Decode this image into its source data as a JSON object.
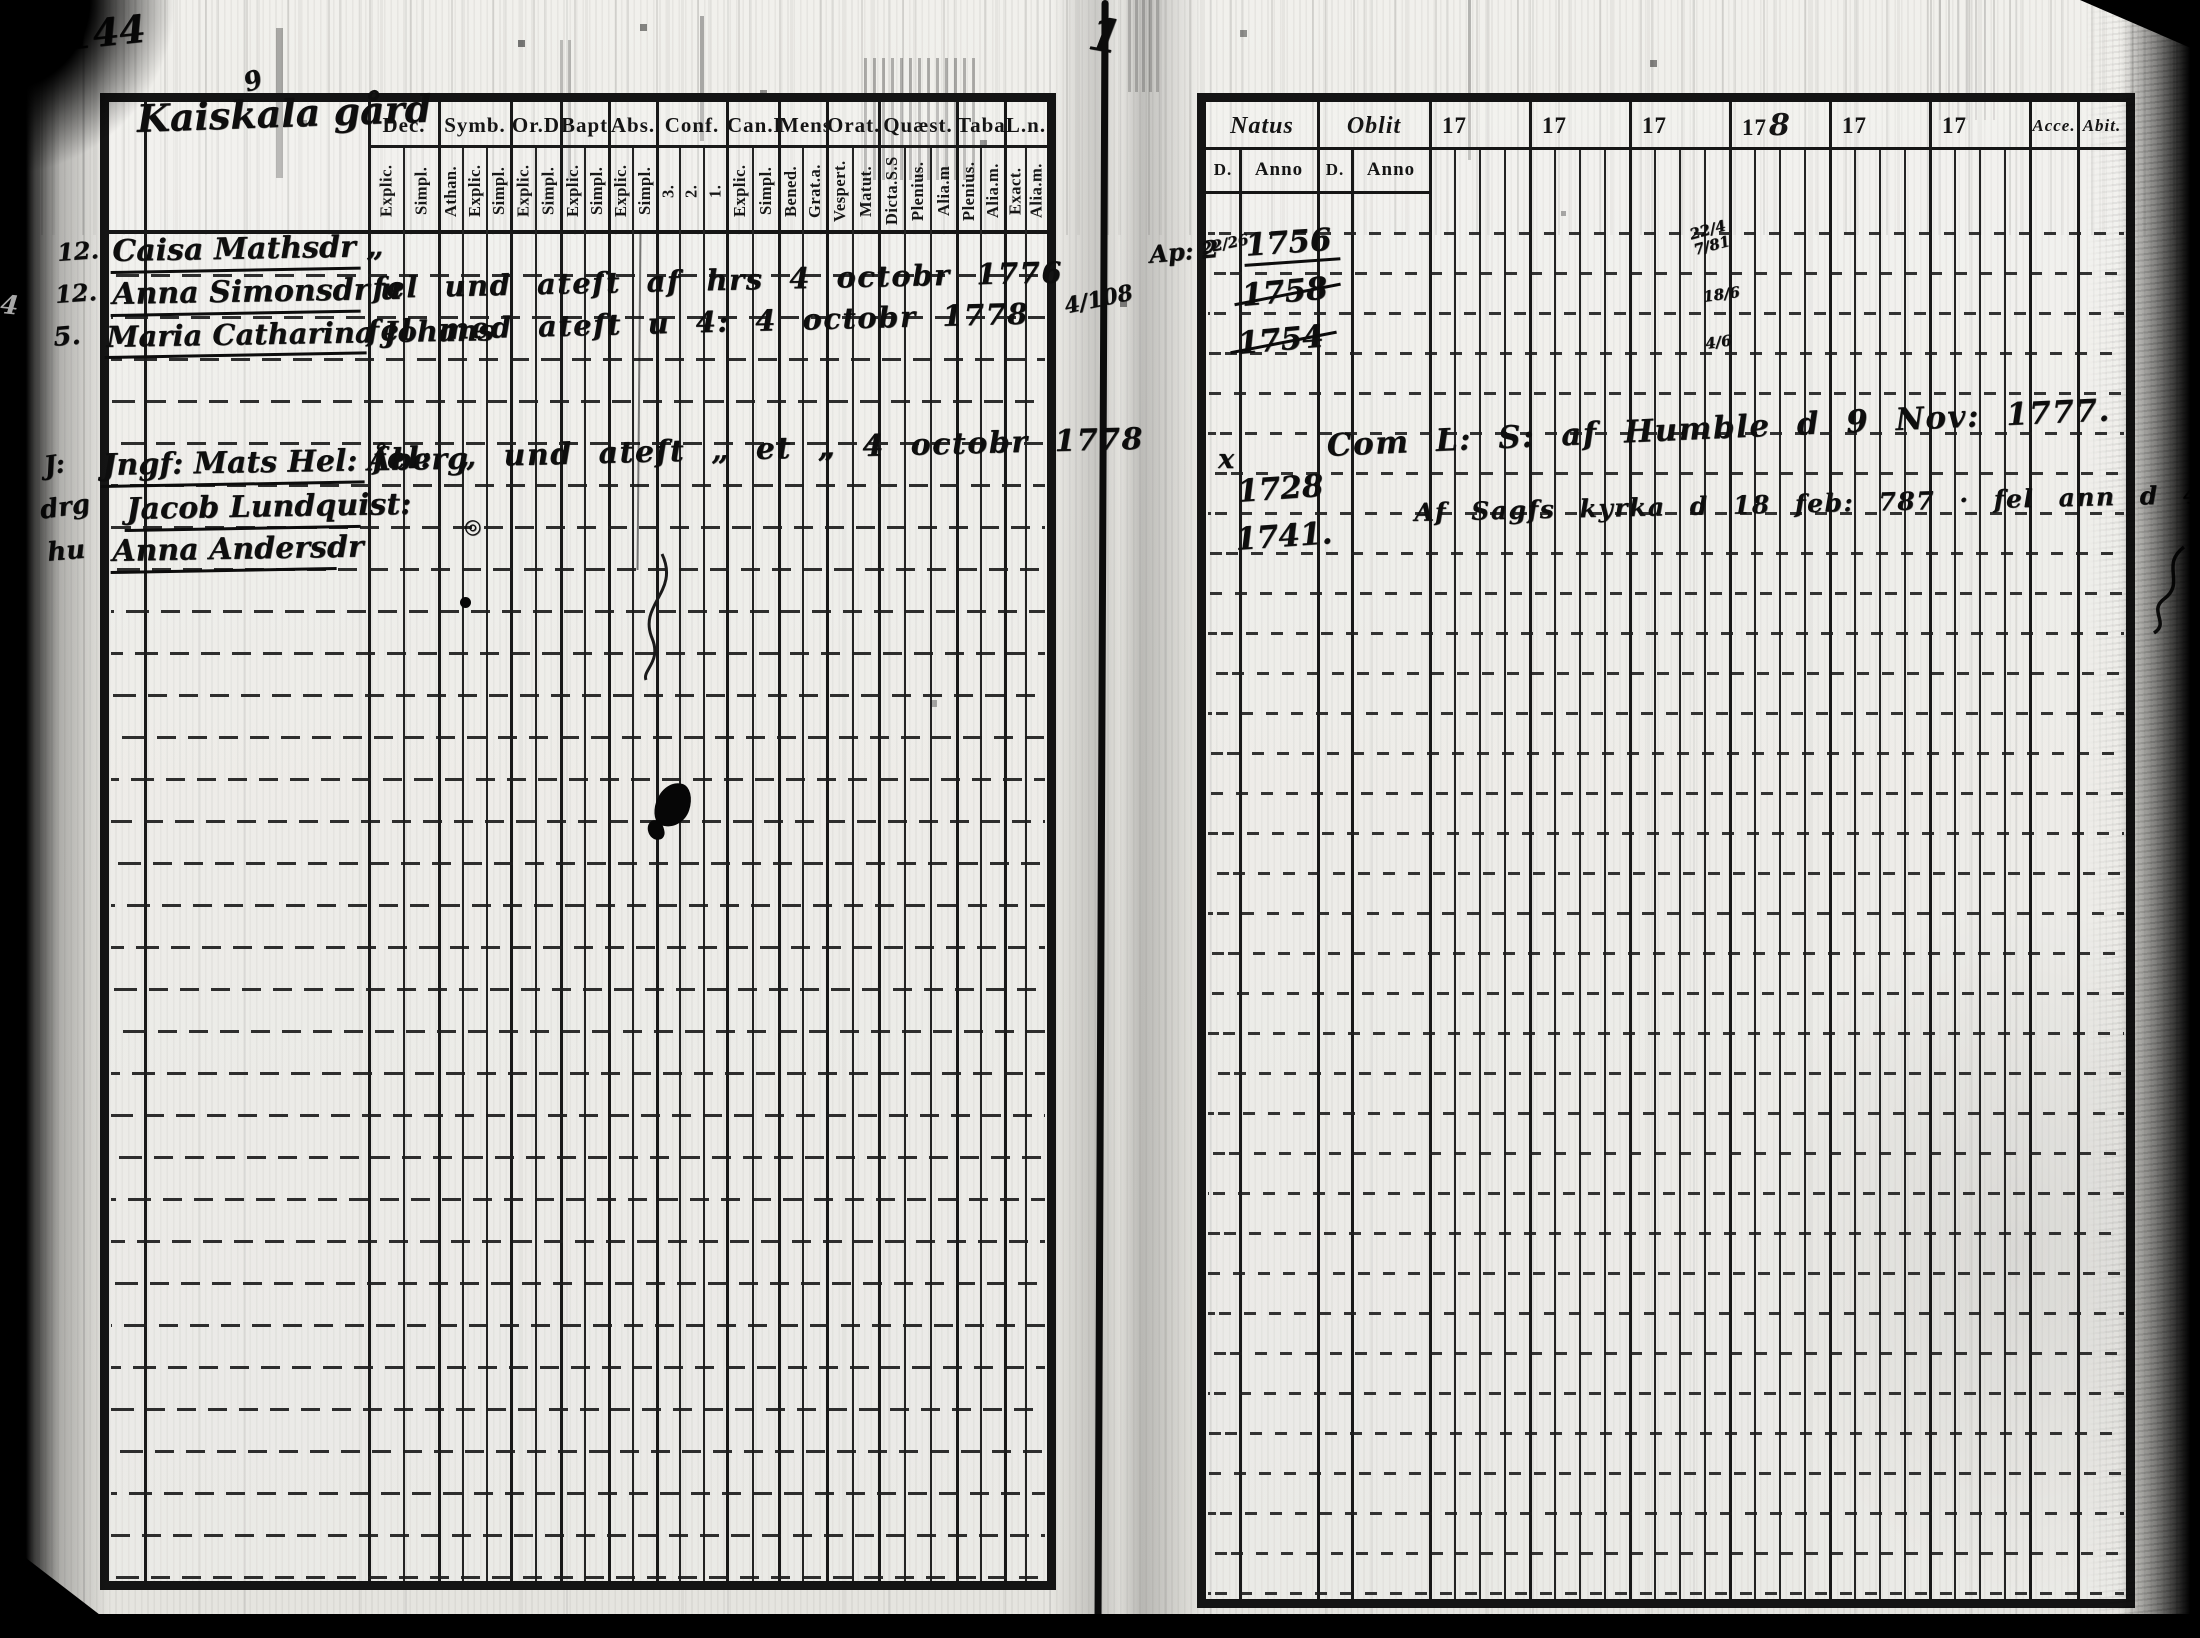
{
  "folio": {
    "left": "144",
    "right_mark": "1"
  },
  "estate": {
    "name": "Kaiskala gård",
    "mark": "9"
  },
  "gutter": {
    "left_note": "4/108",
    "right_note": "Ap: 2"
  },
  "stray": {
    "edge_mark": "4"
  },
  "left_table": {
    "columns": [
      {
        "label": "Dec.",
        "subs": [
          "Explic.",
          "Simpl."
        ]
      },
      {
        "label": "Symb.",
        "subs": [
          "Athan.",
          "Explic.",
          "Simpl."
        ]
      },
      {
        "label": "Or.D",
        "subs": [
          "Explic.",
          "Simpl."
        ]
      },
      {
        "label": "Bapt.",
        "subs": [
          "Explic.",
          "Simpl."
        ]
      },
      {
        "label": "Abs.",
        "subs": [
          "Explic.",
          "Simpl."
        ]
      },
      {
        "label": "Conf.",
        "subs": [
          "3.",
          "2.",
          "1."
        ]
      },
      {
        "label": "Can.D",
        "subs": [
          "Explic.",
          "Simpl."
        ]
      },
      {
        "label": "Mens.",
        "subs": [
          "Bened.",
          "Grat.a."
        ]
      },
      {
        "label": "Orat.",
        "subs": [
          "Vespert.",
          "Matut."
        ]
      },
      {
        "label": "Quæst.",
        "subs": [
          "Dicta.S.S",
          "Plenius.",
          "Alia.m"
        ]
      },
      {
        "label": "Taba.",
        "subs": [
          "Plenius.",
          "Alia.m."
        ]
      },
      {
        "label": "L.n.",
        "subs": [
          "Exact.",
          "Alia.m."
        ]
      }
    ],
    "entries": [
      {
        "margin": "12.",
        "name": "Caisa Mathsdr „",
        "note": ""
      },
      {
        "margin": "12.",
        "name": "Anna Simonsdr u",
        "note": "fel und ateſt af hrs  4 octobr 1776"
      },
      {
        "margin": "5.",
        "name": "Maria Catharina Johans",
        "note": "fel med ateſt  u 4:  4 octobr 1778"
      },
      {
        "margin": "J:",
        "name": "Jngf: Mats Hel: Åberg",
        "note": "fel: „ und ateſt „ et „  4 octobr 1778"
      },
      {
        "margin": "drg",
        "name": "Jacob Lundquist:",
        "note": ""
      },
      {
        "margin": "hu",
        "name": "Anna Andersdr",
        "note": ""
      }
    ],
    "ring_mark": "◎"
  },
  "right_table": {
    "header": {
      "natus": "Natus",
      "oblit": "Oblit",
      "day": "D.",
      "anno": "Anno",
      "years": [
        "17",
        "17",
        "17",
        "178",
        "17",
        "17"
      ],
      "acce": "Acce.",
      "abit": "Abit."
    },
    "natus_entries": [
      {
        "day": "22/26",
        "anno": "1756",
        "struck": false
      },
      {
        "day": "",
        "anno": "1758",
        "struck": true
      },
      {
        "day": "",
        "anno": "1754",
        "struck": true
      },
      {
        "day": "x",
        "anno": "",
        "struck": false
      },
      {
        "day": "",
        "anno": "1728",
        "struck": false
      },
      {
        "day": "",
        "anno": "1741.",
        "struck": false
      }
    ],
    "year_marks": [
      "22/4 7/81",
      "18/6",
      "4/6"
    ],
    "notes": [
      "Com L: S: af Humble d 9 Nov: 1777.",
      "Af Sagfs kyrka d 18 feb: 787 · fel ann d 44/6: 150 Oct: 80 hitkom"
    ]
  }
}
